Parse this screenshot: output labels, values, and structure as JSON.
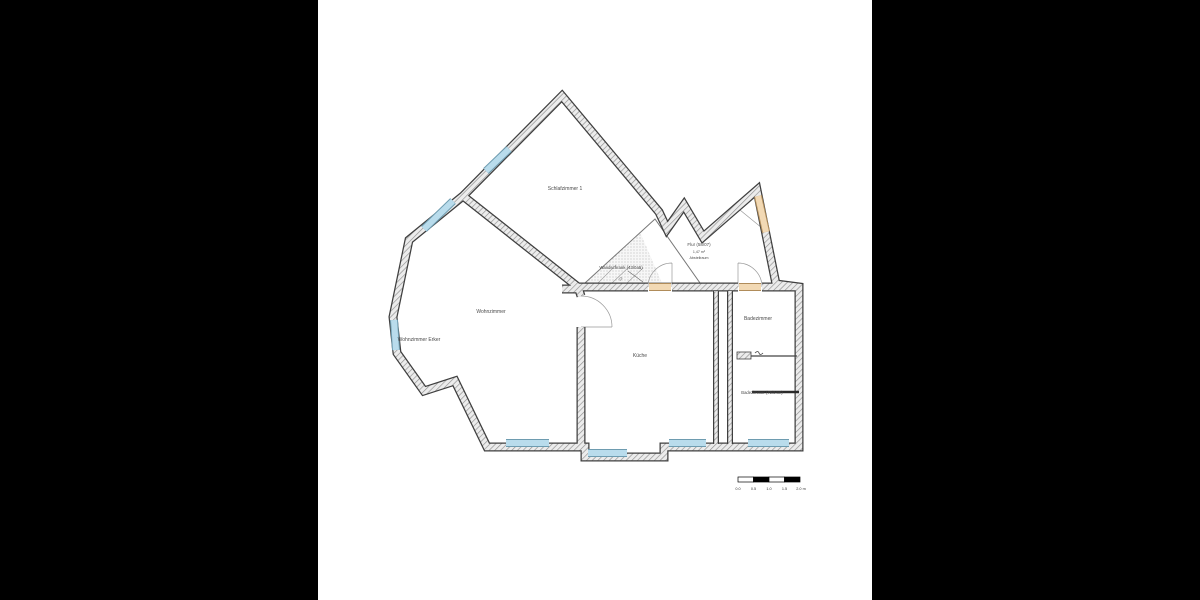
{
  "page": {
    "background": "#ffffff",
    "letterbox_color": "#000000"
  },
  "floorplan": {
    "rooms": {
      "schlafzimmer": "Schlafzimmer 1",
      "wohnzimmer": "Wohnzimmer",
      "wohnzimmer_erker": "Wohnzimmer Erker",
      "kueche": "Küche",
      "badezimmer_1": "Badezimmer",
      "badezimmer_2": "Badezimmer (79/94m)"
    },
    "annotations": {
      "flur_title": "Flur (58/07)",
      "flur_note_1": "1,47 m²",
      "flur_note_2": "Abstellraum",
      "wandschrank": "Wandschrank (43/0a5)",
      "wandschrank_mark": "22"
    },
    "colors": {
      "window": "#b9dcec",
      "window_frame": "#6e9cb0",
      "door": "#f2d9b4",
      "door_frame": "#b08c5a",
      "wall_outline": "#3f3f3f",
      "hatch_line": "#8f8f8f",
      "label": "#4a4a4a"
    },
    "scalebar": {
      "labels": [
        "0.0",
        "0.5",
        "1.0",
        "1.5",
        "2.0 m"
      ]
    }
  }
}
